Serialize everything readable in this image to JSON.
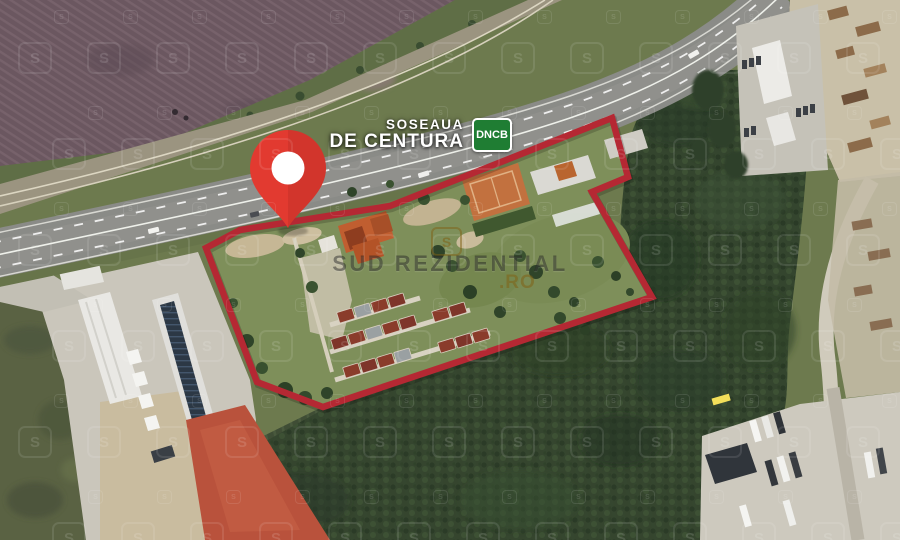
{
  "map": {
    "description": "Satellite view of a land plot outlined in red beside the Bucharest ring road",
    "road_label": {
      "line1": "SOSEAUA",
      "line2": "DE CENTURA",
      "badge": "DNCB"
    },
    "colors": {
      "boundary": "#b52833",
      "pin": "#e23a30",
      "badge_green": "#1f7d33"
    }
  },
  "brand_watermark": {
    "name": "SUD REZIDENTIAL",
    "tld": ".RO",
    "symbol": "S"
  }
}
